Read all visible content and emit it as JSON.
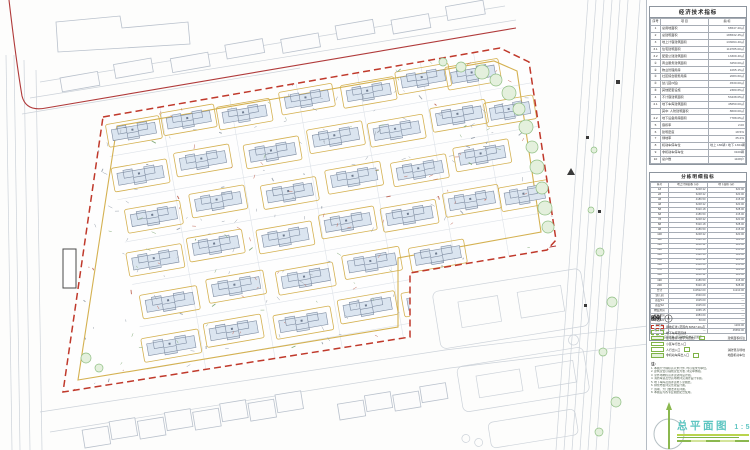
{
  "sheet": {
    "title": "总平面图",
    "scale": "1:500"
  },
  "colors": {
    "boundary_red": "#c0392b",
    "road_red": "#b03a3a",
    "yellow_line": "#d4b151",
    "building_fill": "#dbe5f0",
    "building_stroke": "#7f8da2",
    "tree_stroke": "#8fbf83",
    "tree_fill": "#e4f0dd",
    "context_stroke": "#b9c1cc",
    "faint_stroke": "#ccd2d9",
    "teal_title": "#5fc6c2"
  },
  "econ_table": {
    "title": "经济技术指标",
    "header": [
      "序号",
      "项 目",
      "指 标"
    ],
    "rows": [
      {
        "no": "1",
        "label": "总用地面积",
        "value": "66547.20㎡",
        "indent": 0
      },
      {
        "no": "2",
        "label": "总建筑面积",
        "value": "186532.45㎡",
        "indent": 0
      },
      {
        "no": "3",
        "label": "地上计容建筑面积",
        "value": "133094.40㎡",
        "indent": 0
      },
      {
        "no": "3.1",
        "label": "住宅建筑面积",
        "value": "119785.00㎡",
        "indent": 1
      },
      {
        "no": "3.2",
        "label": "配套公建建筑面积",
        "value": "13309.40㎡",
        "indent": 1
      },
      {
        "no": "①",
        "label": "商业服务建筑面积",
        "value": "3250.00㎡",
        "indent": 2
      },
      {
        "no": "②",
        "label": "物业管理用房",
        "value": "1065.15㎡",
        "indent": 2
      },
      {
        "no": "③",
        "label": "社区综合服务用房",
        "value": "2083.60㎡",
        "indent": 2
      },
      {
        "no": "④",
        "label": "幼儿园(9班)",
        "value": "4530.00㎡",
        "indent": 2
      },
      {
        "no": "⑤",
        "label": "其他配套设施",
        "value": "2380.65㎡",
        "indent": 2
      },
      {
        "no": "4",
        "label": "不计容建筑面积",
        "value": "53438.05㎡",
        "indent": 0
      },
      {
        "no": "4.1",
        "label": "地下车库建筑面积",
        "value": "45650.00㎡",
        "indent": 1
      },
      {
        "no": "",
        "label": "其中: 人防建筑面积",
        "value": "8600.00㎡",
        "indent": 2
      },
      {
        "no": "4.2",
        "label": "地下设备用房面积",
        "value": "7788.05㎡",
        "indent": 1
      },
      {
        "no": "5",
        "label": "容积率",
        "value": "2.00",
        "indent": 0
      },
      {
        "no": "6",
        "label": "建筑密度",
        "value": "18.5%",
        "indent": 0
      },
      {
        "no": "7",
        "label": "绿地率",
        "value": "35.2%",
        "indent": 0
      },
      {
        "no": "8",
        "label": "机动车停车位",
        "value": "地上 186辆 / 地下 1364辆",
        "indent": 0
      },
      {
        "no": "9",
        "label": "非机动车停车位",
        "value": "3100辆",
        "indent": 0
      },
      {
        "no": "10",
        "label": "总户数",
        "value": "1108户",
        "indent": 0
      }
    ]
  },
  "detail_table": {
    "title": "分栋明细指标",
    "header": [
      "栋号",
      "地上计容面积 (㎡)",
      "地下面积 (㎡)"
    ],
    "rows": [
      [
        "1#",
        "6248.32",
        "620.00"
      ],
      [
        "2#",
        "6248.32",
        "620.00"
      ],
      [
        "3#",
        "4186.50",
        "415.00"
      ],
      [
        "4#",
        "6248.32",
        "620.00"
      ],
      [
        "5#",
        "5320.18",
        "528.00"
      ],
      [
        "6#",
        "4186.50",
        "415.00"
      ],
      [
        "7#",
        "6248.32",
        "620.00"
      ],
      [
        "8#",
        "5320.18",
        "528.00"
      ],
      [
        "9#",
        "4186.50",
        "415.00"
      ],
      [
        "10#",
        "6248.32",
        "620.00"
      ],
      [
        "11#",
        "5320.18",
        "528.00"
      ],
      [
        "12#",
        "6248.32",
        "620.00"
      ],
      [
        "13#",
        "4186.50",
        "415.00"
      ],
      [
        "14#",
        "5320.18",
        "528.00"
      ],
      [
        "15#",
        "6248.32",
        "620.00"
      ],
      [
        "16#",
        "4186.50",
        "415.00"
      ],
      [
        "17#",
        "5320.18",
        "528.00"
      ],
      [
        "18#",
        "6248.32",
        "620.00"
      ],
      [
        "19#",
        "4186.50",
        "415.00"
      ],
      [
        "20#",
        "5320.18",
        "528.00"
      ],
      [
        "合计",
        "110522.00",
        "11210.00"
      ],
      [
        "幼儿园",
        "4530.00",
        "—"
      ],
      [
        "商业S1",
        "1625.00",
        "—"
      ],
      [
        "商业S2",
        "1625.00",
        "—"
      ],
      [
        "物业用房",
        "1065.15",
        "—"
      ],
      [
        "社区用房",
        "2083.60",
        "—"
      ],
      [
        "门卫1/2",
        "50.00",
        "—"
      ],
      [
        "换热站",
        "—",
        "1200.00"
      ],
      [
        "地下车库",
        "—",
        "45650.00"
      ]
    ],
    "footnote": "注: 面积以实测为准, 详见单体及地下室图纸"
  },
  "legend": {
    "title": "图例",
    "items": [
      {
        "label": "用地红线 (范围内 66547.20㎡)",
        "right": ""
      },
      {
        "label": "地下车库范围线",
        "right": ""
      },
      {
        "label": "住宅楼栋 (数字为层数)",
        "right": "建筑面积标注"
      },
      {
        "label": "小区车行出入口",
        "right": ""
      },
      {
        "label": "人行出入口",
        "right": "消防登高场地"
      },
      {
        "label": "非机动车库出入口",
        "right": "地面机动车位"
      }
    ]
  },
  "notes": {
    "title": "注:",
    "lines": [
      "1. 本图尺寸除标高以米计外, 均以毫米为单位。",
      "2. 建筑定位以轴线定位为准, 详见单体图。",
      "3. 室外场地标高详见竖向设计图。",
      "4. 消防车道及登高场地详见消防设计专篇。",
      "5. 地下车库范围详见地下室图纸。",
      "6. 绿化布置详见景观设计图。",
      "7. 围墙、大门做法详见详图。",
      "8. 本图应与各专业图纸配合使用。"
    ]
  },
  "site": {
    "boundary": [
      [
        103,
        117
      ],
      [
        500,
        48
      ],
      [
        529,
        62
      ],
      [
        556,
        240
      ],
      [
        547,
        250
      ],
      [
        410,
        273
      ],
      [
        410,
        337
      ],
      [
        63,
        392
      ]
    ],
    "inner_ring": [
      [
        117,
        126
      ],
      [
        494,
        61
      ],
      [
        517,
        71
      ],
      [
        541,
        232
      ],
      [
        398,
        258
      ],
      [
        398,
        327
      ],
      [
        78,
        380
      ]
    ],
    "road_red_top": "M 9,0 Q 16,60 22,96 Q 26,112 46,108 L 516,28",
    "road_red_bottom": [
      "M 70,388 L 408,333",
      "M 405,333 L 405,274",
      "M 410,270 L 556,246"
    ],
    "rotation_deg": -9.9,
    "origin": [
      103,
      117
    ],
    "buildings": [
      [
        6,
        12,
        44,
        15
      ],
      [
        62,
        10,
        44,
        15
      ],
      [
        118,
        14,
        44,
        15
      ],
      [
        182,
        10,
        44,
        15
      ],
      [
        244,
        14,
        44,
        15
      ],
      [
        300,
        10,
        44,
        15
      ],
      [
        350,
        14,
        44,
        15
      ],
      [
        4,
        56,
        46,
        16
      ],
      [
        68,
        52,
        46,
        16
      ],
      [
        138,
        56,
        46,
        16
      ],
      [
        203,
        52,
        46,
        16
      ],
      [
        264,
        56,
        46,
        16
      ],
      [
        328,
        52,
        46,
        16
      ],
      [
        382,
        56,
        40,
        16
      ],
      [
        10,
        99,
        46,
        16
      ],
      [
        76,
        95,
        46,
        16
      ],
      [
        148,
        99,
        46,
        16
      ],
      [
        214,
        95,
        46,
        16
      ],
      [
        280,
        99,
        46,
        16
      ],
      [
        344,
        95,
        46,
        16
      ],
      [
        4,
        142,
        46,
        16
      ],
      [
        66,
        138,
        46,
        16
      ],
      [
        136,
        142,
        46,
        16
      ],
      [
        200,
        138,
        46,
        16
      ],
      [
        262,
        142,
        46,
        16
      ],
      [
        326,
        138,
        46,
        16
      ],
      [
        382,
        142,
        40,
        16
      ],
      [
        10,
        186,
        48,
        16
      ],
      [
        78,
        182,
        48,
        16
      ],
      [
        148,
        186,
        48,
        16
      ],
      [
        216,
        182,
        48,
        16
      ],
      [
        283,
        186,
        46,
        16
      ],
      [
        4,
        229,
        48,
        16
      ],
      [
        68,
        225,
        48,
        16
      ],
      [
        138,
        229,
        48,
        16
      ],
      [
        204,
        225,
        48,
        16
      ],
      [
        268,
        229,
        46,
        16
      ]
    ],
    "trees": [
      [
        482,
        72,
        7
      ],
      [
        496,
        80,
        6
      ],
      [
        509,
        93,
        7
      ],
      [
        519,
        109,
        6
      ],
      [
        526,
        127,
        7
      ],
      [
        532,
        147,
        6
      ],
      [
        537,
        167,
        7
      ],
      [
        542,
        188,
        6
      ],
      [
        545,
        208,
        7
      ],
      [
        548,
        227,
        6
      ],
      [
        461,
        67,
        5
      ],
      [
        443,
        62,
        4
      ],
      [
        86,
        358,
        5
      ],
      [
        99,
        368,
        4
      ],
      [
        600,
        252,
        4
      ],
      [
        612,
        302,
        5
      ],
      [
        603,
        352,
        4
      ],
      [
        616,
        402,
        5
      ],
      [
        599,
        432,
        4
      ],
      [
        591,
        210,
        3
      ],
      [
        594,
        150,
        3
      ]
    ]
  }
}
